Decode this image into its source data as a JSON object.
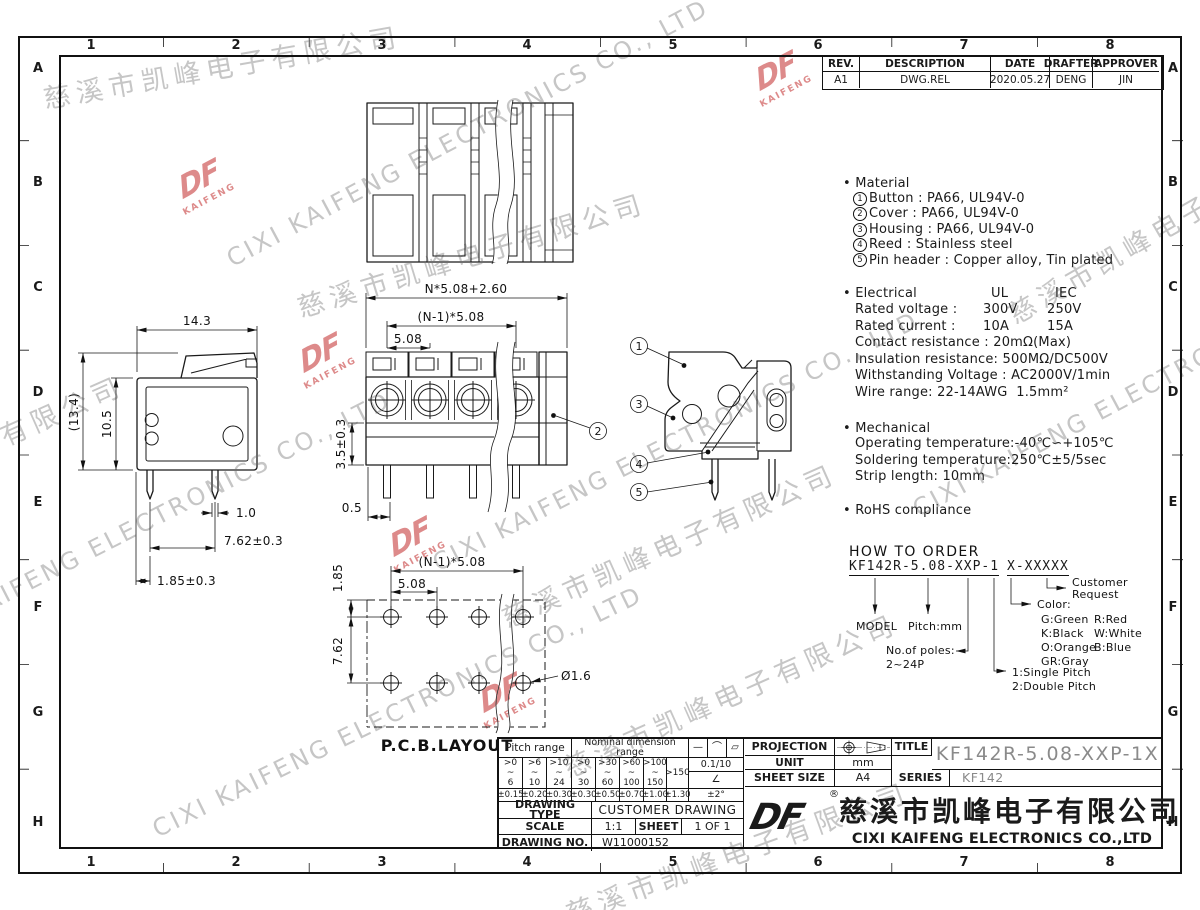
{
  "page": {
    "paper": "#ffffff",
    "ink": "#1a1a1a",
    "gray_text": "#8a8a8a",
    "watermark": "#c6c6c6",
    "logo_red": "#dd8a8a"
  },
  "grid": {
    "cols": [
      "1",
      "2",
      "3",
      "4",
      "5",
      "6",
      "7",
      "8"
    ],
    "rows": [
      "A",
      "B",
      "C",
      "D",
      "E",
      "F",
      "G",
      "H"
    ]
  },
  "revision_table": {
    "headers": [
      "REV.",
      "DESCRIPTION",
      "DATE",
      "DRAFTER",
      "APPROVER"
    ],
    "row": [
      "A1",
      "DWG.REL",
      "2020.05.27",
      "DENG",
      "JIN"
    ]
  },
  "notes": {
    "material": {
      "title": "Material",
      "items": [
        {
          "n": "1",
          "t": "Button : PA66, UL94V-0"
        },
        {
          "n": "2",
          "t": "Cover : PA66, UL94V-0"
        },
        {
          "n": "3",
          "t": "Housing : PA66, UL94V-0"
        },
        {
          "n": "4",
          "t": "Reed : Stainless steel"
        },
        {
          "n": "5",
          "t": "Pin header : Copper alloy, Tin plated"
        }
      ]
    },
    "electrical": {
      "title": "Electrical",
      "col1": "UL",
      "col2": "IEC",
      "rows": [
        {
          "label": "Rated voltage :",
          "ul": "300V",
          "iec": "250V"
        },
        {
          "label": "Rated current :",
          "ul": "10A",
          "iec": "15A"
        }
      ],
      "lines": [
        "Contact resistance : 20mΩ(Max)",
        "Insulation resistance: 500MΩ/DC500V",
        "Withstanding Voltage : AC2000V/1min",
        "Wire range: 22-14AWG  1.5mm²"
      ]
    },
    "mechanical": {
      "title": "Mechanical",
      "lines": [
        "Operating temperature:-40℃∽+105℃",
        "Soldering temperature:250℃±5/5sec",
        "Strip length: 10mm"
      ]
    },
    "rohs": "RoHS compliance"
  },
  "order": {
    "title": "HOW TO ORDER",
    "code_left": "KF142R-5.08-XXP-1",
    "code_right": "X-XXXXX",
    "labels": {
      "model": "MODEL",
      "pitch": "Pitch:mm",
      "poles": "No.of poles:",
      "poles_range": "2~24P",
      "single": "1:Single Pitch",
      "double": "2:Double Pitch",
      "color": "Color:",
      "colors": [
        [
          "G:Green",
          "R:Red"
        ],
        [
          "K:Black",
          "W:White"
        ],
        [
          "O:Orange",
          "B:Blue"
        ],
        [
          "GR:Gray",
          ""
        ]
      ],
      "customer1": "Customer",
      "customer2": "Request"
    }
  },
  "dims": {
    "side": {
      "w": "14.3",
      "h_ref": "(13.4)",
      "h": "10.5",
      "pin_w": "1.0",
      "pitch": "7.62±0.3",
      "offset": "1.85±0.3"
    },
    "front": {
      "total": "N*5.08+2.60",
      "span": "(N-1)*5.08",
      "pitch": "5.08",
      "h": "3.5±0.3",
      "off": "0.5"
    },
    "pcb": {
      "label": "P.C.B.LAYOUT",
      "row_off": "1.85",
      "span": "(N-1)*5.08",
      "pitch": "5.08",
      "rows": "7.62",
      "hole": "Ø1.6"
    },
    "callouts": [
      "1",
      "2",
      "3",
      "4",
      "5"
    ]
  },
  "tolerance_table": {
    "pitch_header": "Pitch range",
    "nominal_header": "Nominal dimension range",
    "symbols": [
      "—",
      "⌒",
      "▱"
    ],
    "pitch_cols": [
      ">0\n~\n6",
      ">6\n~\n10",
      ">10\n~\n24"
    ],
    "nominal_cols": [
      ">0\n~\n30",
      ">30\n~\n60",
      ">60\n~\n100",
      ">100\n~\n150"
    ],
    "nominal_last": ">150",
    "flatness": "0.1/10",
    "angle_sym": "∠",
    "pitch_tols": [
      "±0.15",
      "±0.20",
      "±0.30"
    ],
    "nominal_tols": [
      "±0.30",
      "±0.50",
      "±0.70",
      "±1.00",
      "±1.30"
    ],
    "angle_tol": "±2°"
  },
  "title_block": {
    "projection_label": "PROJECTION",
    "unit_label": "UNIT",
    "unit_value": "mm",
    "sheet_size_label": "SHEET SIZE",
    "sheet_size_value": "A4",
    "title_label": "TITLE",
    "title_value": "KF142R-5.08-XXP-1X",
    "series_label": "SERIES",
    "series_value": "KF142",
    "drawing_type_label": "DRAWING TYPE",
    "drawing_type_value": "CUSTOMER DRAWING",
    "scale_label": "SCALE",
    "scale_value": "1:1",
    "sheet_label": "SHEET",
    "sheet_value": "1 OF 1",
    "drawing_no_label": "DRAWING NO.",
    "drawing_no_value": "W11000152",
    "company_cn": "慈溪市凯峰电子有限公司",
    "company_en": "CIXI KAIFENG ELECTRONICS CO.,LTD",
    "logo_text": "DF",
    "reg_mark": "®"
  },
  "watermark": {
    "cn": "慈溪市凯峰电子有限公司",
    "en": "CIXI KAIFENG ELECTRONICS CO., LTD",
    "logo_top": "DF",
    "logo_bottom": "KAIFENG"
  }
}
